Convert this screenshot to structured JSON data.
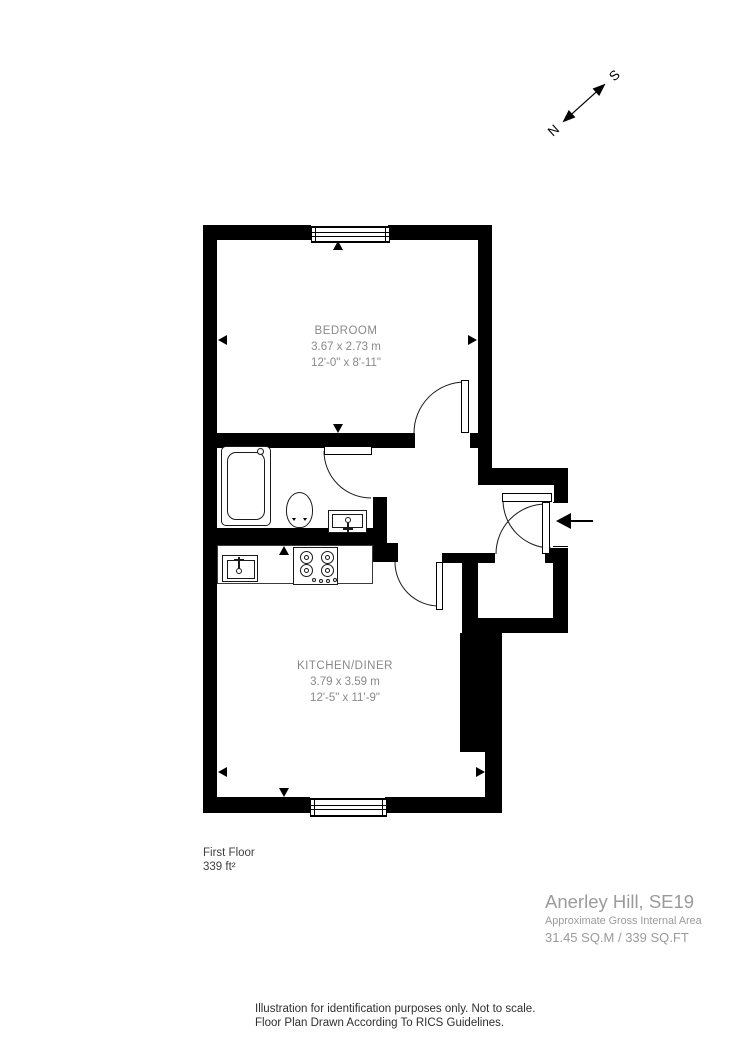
{
  "compass": {
    "north": "N",
    "south": "S"
  },
  "rooms": [
    {
      "name": "BEDROOM",
      "dims_metric": "3.67 x 2.73 m",
      "dims_imperial": "12'-0\" x 8'-11\""
    },
    {
      "name": "KITCHEN/DINER",
      "dims_metric": "3.79 x 3.59 m",
      "dims_imperial": "12'-5\" x 11'-9\""
    }
  ],
  "floor_label": {
    "name": "First Floor",
    "area": "339 ft²"
  },
  "title_block": {
    "address": "Anerley Hill, SE19",
    "subtitle": "Approximate Gross Internal Area",
    "total_area": "31.45 SQ.M / 339 SQ.FT"
  },
  "disclaimer": {
    "line1": "Illustration for identification purposes only. Not to scale.",
    "line2": "Floor Plan Drawn According To RICS Guidelines."
  },
  "colors": {
    "wall": "#000000",
    "room_label": "#898989",
    "title": "#9b9b9b",
    "footer": "#2f2f2f"
  }
}
